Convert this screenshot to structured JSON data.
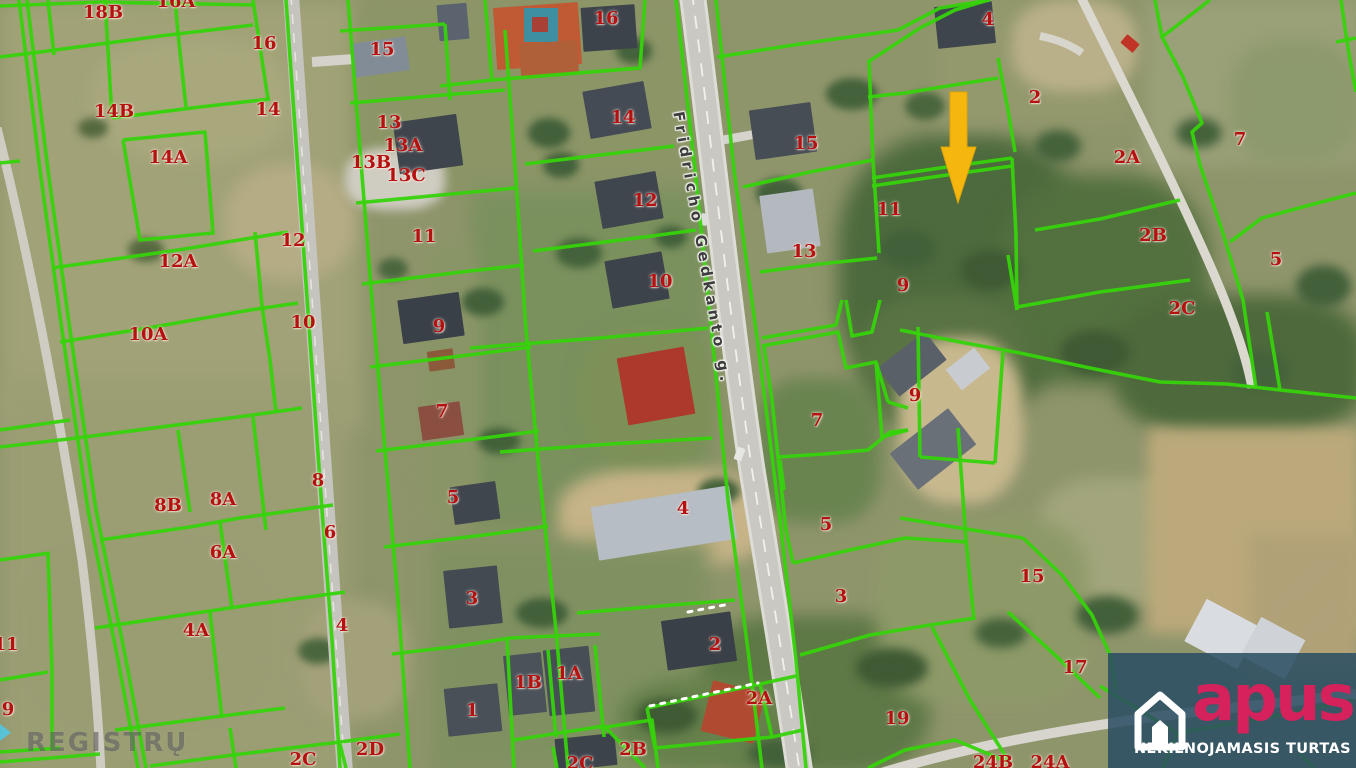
{
  "street_label": "Fridricho Gedkanto g.",
  "watermark_text": "REGISTRŲ",
  "logo": {
    "brand": "apus",
    "tagline": "NEKILNOJAMASIS TURTAS",
    "brand_color": "#d5215c",
    "panel_color": "rgba(44,78,99,0.87)"
  },
  "colors": {
    "parcel_line": "#36d30b",
    "label_red": "#b51111",
    "arrow": "#f5b60d",
    "road": "#c9c8c2",
    "road_dash": "#f2f1ec"
  },
  "arrow_points": "950,92 967,92 967,147 976,147 958,203 941,147 950,147",
  "parcel_labels": [
    [
      "18B",
      103,
      13
    ],
    [
      "16A",
      176,
      2
    ],
    [
      "16",
      264,
      44
    ],
    [
      "14B",
      114,
      112
    ],
    [
      "14",
      268,
      110
    ],
    [
      "14A",
      168,
      158
    ],
    [
      "15",
      382,
      50
    ],
    [
      "13",
      389,
      123
    ],
    [
      "13A",
      403,
      146
    ],
    [
      "13B",
      371,
      163
    ],
    [
      "13C",
      406,
      176
    ],
    [
      "16",
      606,
      19
    ],
    [
      "14",
      623,
      118
    ],
    [
      "12",
      645,
      201
    ],
    [
      "12",
      293,
      241
    ],
    [
      "12A",
      178,
      262
    ],
    [
      "11",
      424,
      237
    ],
    [
      "10",
      303,
      323
    ],
    [
      "10A",
      148,
      335
    ],
    [
      "10",
      660,
      282
    ],
    [
      "9",
      439,
      327
    ],
    [
      "11",
      6,
      645
    ],
    [
      "9",
      8,
      710
    ],
    [
      "15",
      806,
      144
    ],
    [
      "13",
      804,
      252
    ],
    [
      "11",
      889,
      210
    ],
    [
      "9",
      903,
      286
    ],
    [
      "9",
      915,
      396
    ],
    [
      "7",
      817,
      421
    ],
    [
      "7",
      442,
      412
    ],
    [
      "4",
      988,
      20
    ],
    [
      "2",
      1035,
      98
    ],
    [
      "2A",
      1127,
      158
    ],
    [
      "2B",
      1153,
      236
    ],
    [
      "2C",
      1182,
      309
    ],
    [
      "7",
      1240,
      140
    ],
    [
      "5",
      1276,
      260
    ],
    [
      "8",
      318,
      481
    ],
    [
      "8A",
      223,
      500
    ],
    [
      "8B",
      168,
      506
    ],
    [
      "6",
      330,
      533
    ],
    [
      "6A",
      223,
      553
    ],
    [
      "5",
      453,
      498
    ],
    [
      "5",
      826,
      525
    ],
    [
      "4",
      683,
      509
    ],
    [
      "3",
      472,
      599
    ],
    [
      "3",
      841,
      597
    ],
    [
      "4",
      342,
      626
    ],
    [
      "4A",
      196,
      631
    ],
    [
      "1",
      472,
      711
    ],
    [
      "1B",
      528,
      683
    ],
    [
      "1A",
      569,
      674
    ],
    [
      "2",
      715,
      645
    ],
    [
      "2A",
      759,
      699
    ],
    [
      "2B",
      633,
      750
    ],
    [
      "2C",
      580,
      764
    ],
    [
      "2C",
      303,
      760
    ],
    [
      "2D",
      370,
      750
    ],
    [
      "15",
      1032,
      577
    ],
    [
      "17",
      1075,
      668
    ],
    [
      "19",
      897,
      719
    ],
    [
      "24B",
      993,
      763
    ],
    [
      "24A",
      1050,
      763
    ]
  ],
  "parcel_lines": [
    "19,0 40,170 62,330 88,510 118,660 138,768",
    "27,0 48,170 70,330 96,510 126,660 146,768",
    "48,0 54,55",
    "105,0 112,118",
    "0,57 40,52 160,36 253,25",
    "112,118 200,107 270,99",
    "175,0 178,33",
    "178,33 186,107",
    "253,0 262,60 268,99",
    "286,0 298,170 310,340 322,510 332,640 340,768",
    "123,140 205,132 213,233 140,240 123,140",
    "52,268 178,250 288,232",
    "255,232 262,306",
    "262,306 270,360 276,412",
    "60,342 148,328 250,310 298,303",
    "0,163 20,161",
    "0,430 70,420",
    "0,447 85,437 253,415 302,408",
    "178,430 190,512",
    "253,417 266,530",
    "100,540 190,527 240,518 333,505",
    "220,522 232,608",
    "95,628 196,613 250,605 345,592",
    "210,612 222,718",
    "115,730 222,716 285,708",
    "230,728 236,768",
    "150,766 233,755 340,742 400,734",
    "340,744 346,768",
    "0,560 50,553",
    "48,553 52,672 52,750",
    "0,680 48,672",
    "0,752 60,748",
    "0,762 100,754",
    "0,6 100,2 255,5",
    "348,0 360,150 372,300 385,450 398,600 410,768",
    "340,31 445,24",
    "445,24 450,100",
    "350,103 455,94 505,90",
    "356,203 462,193 516,188",
    "505,30 516,180 526,330 540,480 556,630 568,768",
    "362,284 470,271 524,265",
    "370,367 477,354 531,347",
    "376,451 484,438 539,431",
    "384,547 492,534 548,526",
    "392,654 460,646 510,638 600,634",
    "507,638 514,768",
    "548,650 556,737",
    "595,645 604,737",
    "514,740 604,726",
    "604,726 645,768",
    "485,0 492,80 640,68 645,0",
    "440,86 492,80",
    "525,164 642,150 674,146",
    "533,251 652,236 696,230",
    "470,348 600,338 708,328",
    "500,452 610,444 712,438",
    "577,613 660,606 735,600",
    "600,728 652,720 658,768",
    "553,747 557,768",
    "647,708 760,684 772,737 655,748 647,708",
    "760,684 796,676",
    "772,737 803,730",
    "676,0 695,170 712,335 728,500 748,650 762,768",
    "716,0 734,170 758,345 780,520 796,660 806,768",
    "717,57 800,44 898,30 940,8 990,0",
    "743,187 810,172 873,160",
    "873,160 879,253",
    "760,272 820,264 877,258",
    "869,60 873,160",
    "868,62 920,28 955,10 988,0",
    "868,97 905,93 960,84 998,78",
    "998,58 1008,110 1015,152",
    "872,178 940,168 1012,158",
    "872,186 940,176 1012,166",
    "1012,158 1016,235 1017,310",
    "762,338 836,325 842,300",
    "762,346 838,332 846,368 876,362 888,402",
    "846,300 852,336 872,332 880,300",
    "876,362 882,437 908,430",
    "764,346 772,400 778,457",
    "778,457 824,454 868,450 890,432 908,430",
    "780,460 784,490",
    "888,402 908,408",
    "778,457 786,530 793,563",
    "793,563 850,550 905,538 966,542",
    "958,428 966,540 974,620",
    "800,655 870,635 930,625 975,618",
    "932,627 970,700 1010,763",
    "1008,612 1056,656 1100,698",
    "900,330 960,342 1020,353",
    "918,327 920,457",
    "920,457 995,463",
    "995,463 1003,352",
    "1020,353 1090,368 1160,382 1227,384 1280,390 1356,398",
    "900,518 960,528 1023,538",
    "1023,538 1062,575 1092,615 1110,655 1116,690",
    "868,768 905,750 955,740 1008,762",
    "1100,686 1177,733 1280,715 1353,700",
    "1177,733 1163,768",
    "1300,753 1313,768",
    "1155,0 1162,37 1183,77 1202,123 1192,132 1200,165 1222,230 1243,300 1256,388",
    "1162,37 1210,0",
    "1341,0 1345,28 1350,60 1356,92",
    "1336,42 1356,38",
    "1230,242 1262,218 1310,205 1356,193",
    "1267,312 1280,390",
    "1017,307 1100,292 1190,280",
    "1035,230 1100,219 1180,200",
    "1008,255 1017,310"
  ],
  "dotted_lines": [
    "688,612 730,604",
    "650,706 758,683"
  ],
  "roads": [
    {
      "d": "M692,-8 C710,130 730,320 752,470 C770,580 788,690 800,774",
      "w": 27,
      "c": "#dedcd6"
    },
    {
      "d": "M692,-8 C710,130 730,320 752,470 C770,580 788,690 800,774",
      "w": 21,
      "c": "#c9c8c2"
    },
    {
      "d": "M692,-8 C710,130 730,320 752,470 C770,580 788,690 800,774",
      "w": 1.8,
      "c": "#f2f1ec",
      "dash": "13 11"
    },
    {
      "d": "M291,-5 L345,773",
      "w": 16,
      "c": "#c5c4be"
    },
    {
      "d": "M291,-5 L345,773",
      "w": 1.5,
      "c": "#e8e6e0",
      "dash": "10 9"
    },
    {
      "d": "M1080,-5 C1112,60 1168,170 1210,265 C1232,315 1246,355 1252,388",
      "w": 9,
      "c": "#dbd8cf"
    },
    {
      "d": "M875,775 C960,748 1060,730 1160,716 L1356,694",
      "w": 10,
      "c": "#d7d5cd"
    },
    {
      "d": "M-3,128 C35,280 65,450 82,560 C92,640 98,710 101,772",
      "w": 9,
      "c": "#cfccc3"
    },
    {
      "d": "M312,62 L368,58",
      "w": 10,
      "c": "#d4d2ca"
    },
    {
      "d": "M723,140 L762,133",
      "w": 9,
      "c": "#d5d3cb"
    },
    {
      "d": "M1040,36 C1060,40 1072,46 1082,53",
      "w": 8,
      "c": "#d8d5cc"
    }
  ],
  "houses": [
    [
      495,
      5,
      85,
      62,
      -4,
      "#bf5a35"
    ],
    [
      524,
      8,
      34,
      34,
      0,
      "#3e8fa0"
    ],
    [
      532,
      17,
      16,
      15,
      0,
      "#a84038"
    ],
    [
      582,
      6,
      54,
      44,
      -4,
      "#3d434b"
    ],
    [
      520,
      42,
      58,
      34,
      -4,
      "#b06038"
    ],
    [
      438,
      4,
      30,
      36,
      -5,
      "#5a636e"
    ],
    [
      352,
      40,
      56,
      34,
      -8,
      "#828c96"
    ],
    [
      396,
      118,
      64,
      52,
      -8,
      "#3f454d"
    ],
    [
      586,
      86,
      62,
      48,
      -10,
      "#454b54"
    ],
    [
      598,
      176,
      62,
      48,
      -10,
      "#40464e"
    ],
    [
      608,
      256,
      58,
      48,
      -10,
      "#3d434b"
    ],
    [
      400,
      296,
      62,
      44,
      -8,
      "#3a4048"
    ],
    [
      420,
      404,
      42,
      34,
      -8,
      "#8a4f41"
    ],
    [
      428,
      350,
      26,
      20,
      -8,
      "#8a5a3a"
    ],
    [
      622,
      352,
      68,
      68,
      -10,
      "#ac392b"
    ],
    [
      452,
      484,
      46,
      38,
      -8,
      "#40464e"
    ],
    [
      446,
      568,
      54,
      58,
      -6,
      "#434a52"
    ],
    [
      594,
      496,
      140,
      54,
      -9,
      "#b6bdc4"
    ],
    [
      446,
      686,
      54,
      48,
      -6,
      "#4a5058"
    ],
    [
      506,
      654,
      38,
      60,
      -6,
      "#4b525a"
    ],
    [
      546,
      648,
      46,
      66,
      -6,
      "#474e56"
    ],
    [
      664,
      616,
      70,
      50,
      -8,
      "#3a4047"
    ],
    [
      706,
      686,
      54,
      52,
      14,
      "#b04a30"
    ],
    [
      556,
      736,
      60,
      32,
      -6,
      "#3c434b"
    ],
    [
      752,
      106,
      62,
      50,
      -8,
      "#474d55"
    ],
    [
      763,
      192,
      54,
      58,
      -8,
      "#b3b9bf"
    ],
    [
      936,
      4,
      58,
      42,
      -6,
      "#3f454d"
    ],
    [
      1122,
      38,
      16,
      11,
      40,
      "#c03326"
    ],
    [
      882,
      346,
      60,
      36,
      -38,
      "#596068"
    ],
    [
      896,
      426,
      74,
      46,
      -38,
      "#6a7078"
    ],
    [
      950,
      356,
      36,
      26,
      -38,
      "#c8ccd1"
    ],
    [
      1192,
      610,
      60,
      48,
      28,
      "#d9dce0"
    ],
    [
      1248,
      626,
      50,
      44,
      28,
      "#cfd3d8"
    ],
    [
      733,
      450,
      13,
      8,
      -70,
      "#e6e6e3"
    ],
    [
      698,
      216,
      12,
      7,
      -78,
      "#dcdcda"
    ]
  ],
  "terrain": [
    [
      0,
      0,
      360,
      430,
      "#a1a277",
      0,
      10
    ],
    [
      0,
      380,
      350,
      400,
      "#9b9d73",
      0,
      10
    ],
    [
      90,
      40,
      200,
      120,
      "#a9a87d",
      40,
      9
    ],
    [
      225,
      165,
      130,
      115,
      "#b5ac85",
      45,
      8
    ],
    [
      355,
      0,
      350,
      190,
      "#8b9566",
      0,
      10
    ],
    [
      345,
      148,
      100,
      62,
      "#cfccc2",
      40,
      5
    ],
    [
      470,
      190,
      240,
      340,
      "#7a905d",
      0,
      10
    ],
    [
      558,
      468,
      215,
      100,
      "#c6b388",
      40,
      8
    ],
    [
      430,
      540,
      280,
      235,
      "#809161",
      0,
      10
    ],
    [
      700,
      615,
      230,
      160,
      "#5e7846",
      35,
      9
    ],
    [
      838,
      135,
      250,
      270,
      "#4c6a3d",
      40,
      10
    ],
    [
      1000,
      175,
      210,
      210,
      "#53703f",
      40,
      10
    ],
    [
      858,
      295,
      170,
      140,
      "#5a7344",
      40,
      9
    ],
    [
      1115,
      295,
      250,
      140,
      "#4e6a3c",
      35,
      9
    ],
    [
      1145,
      0,
      215,
      165,
      "#9aa078",
      0,
      9
    ],
    [
      1230,
      40,
      130,
      125,
      "#8d9a6d",
      40,
      8
    ],
    [
      1038,
      478,
      185,
      125,
      "#a3a67c",
      35,
      8
    ],
    [
      1148,
      428,
      212,
      205,
      "#c3b183",
      0,
      7,
      "#b3a173"
    ],
    [
      1250,
      535,
      110,
      135,
      "#b9a97f",
      0,
      7,
      "#a99970"
    ],
    [
      878,
      518,
      210,
      185,
      "#8d9a68",
      30,
      9
    ],
    [
      898,
      338,
      125,
      165,
      "#c8b88e",
      40,
      7
    ],
    [
      580,
      328,
      135,
      135,
      "#7d9058",
      40,
      8
    ],
    [
      938,
      0,
      190,
      125,
      "#94996d",
      0,
      9
    ],
    [
      1012,
      0,
      125,
      92,
      "#b9b089",
      40,
      7
    ],
    [
      618,
      678,
      185,
      92,
      "#67814c",
      40,
      8
    ],
    [
      756,
      378,
      125,
      145,
      "#6a8450",
      35,
      8
    ],
    [
      418,
      238,
      62,
      290,
      "#8a9567",
      30,
      8
    ],
    [
      40,
      555,
      210,
      155,
      "#9a9c71",
      30,
      9
    ],
    [
      300,
      600,
      110,
      120,
      "#a3a179",
      40,
      8
    ],
    [
      528,
      118,
      42,
      30,
      "#42603a",
      50,
      4
    ],
    [
      543,
      152,
      36,
      26,
      "#42603a",
      50,
      4
    ],
    [
      616,
      38,
      36,
      26,
      "#44623b",
      50,
      4
    ],
    [
      655,
      226,
      32,
      22,
      "#42603a",
      50,
      4
    ],
    [
      556,
      238,
      46,
      30,
      "#44623b",
      50,
      4
    ],
    [
      462,
      288,
      42,
      28,
      "#42603a",
      50,
      4
    ],
    [
      378,
      258,
      30,
      22,
      "#4a663e",
      50,
      4
    ],
    [
      478,
      428,
      42,
      26,
      "#42603a",
      50,
      4
    ],
    [
      516,
      598,
      52,
      30,
      "#42603a",
      50,
      4
    ],
    [
      698,
      478,
      42,
      26,
      "#44623b",
      50,
      4
    ],
    [
      756,
      178,
      46,
      30,
      "#42603a",
      50,
      4
    ],
    [
      826,
      78,
      52,
      32,
      "#44623b",
      50,
      4
    ],
    [
      298,
      638,
      40,
      26,
      "#4a663e",
      50,
      4
    ],
    [
      128,
      238,
      36,
      24,
      "#55693f",
      50,
      4
    ],
    [
      78,
      118,
      30,
      20,
      "#55693f",
      50,
      4
    ],
    [
      1076,
      596,
      62,
      38,
      "#42603a",
      50,
      5
    ],
    [
      975,
      618,
      52,
      30,
      "#44623b",
      50,
      5
    ],
    [
      1296,
      265,
      55,
      42,
      "#42603a",
      50,
      5
    ],
    [
      1176,
      118,
      46,
      30,
      "#44623b",
      50,
      5
    ],
    [
      856,
      648,
      72,
      40,
      "#3f5a34",
      50,
      5
    ],
    [
      636,
      698,
      62,
      36,
      "#3f5a34",
      50,
      5
    ],
    [
      748,
      738,
      62,
      30,
      "#42603a",
      50,
      5
    ],
    [
      905,
      92,
      40,
      28,
      "#4a663e",
      50,
      4
    ],
    [
      1035,
      130,
      46,
      32,
      "#44623b",
      50,
      5
    ],
    [
      960,
      250,
      60,
      40,
      "#3f5a34",
      50,
      5
    ],
    [
      880,
      230,
      55,
      38,
      "#42603a",
      50,
      5
    ],
    [
      1060,
      330,
      70,
      45,
      "#3f5a34",
      50,
      5
    ],
    [
      1230,
      350,
      60,
      40,
      "#44623b",
      50,
      5
    ]
  ]
}
